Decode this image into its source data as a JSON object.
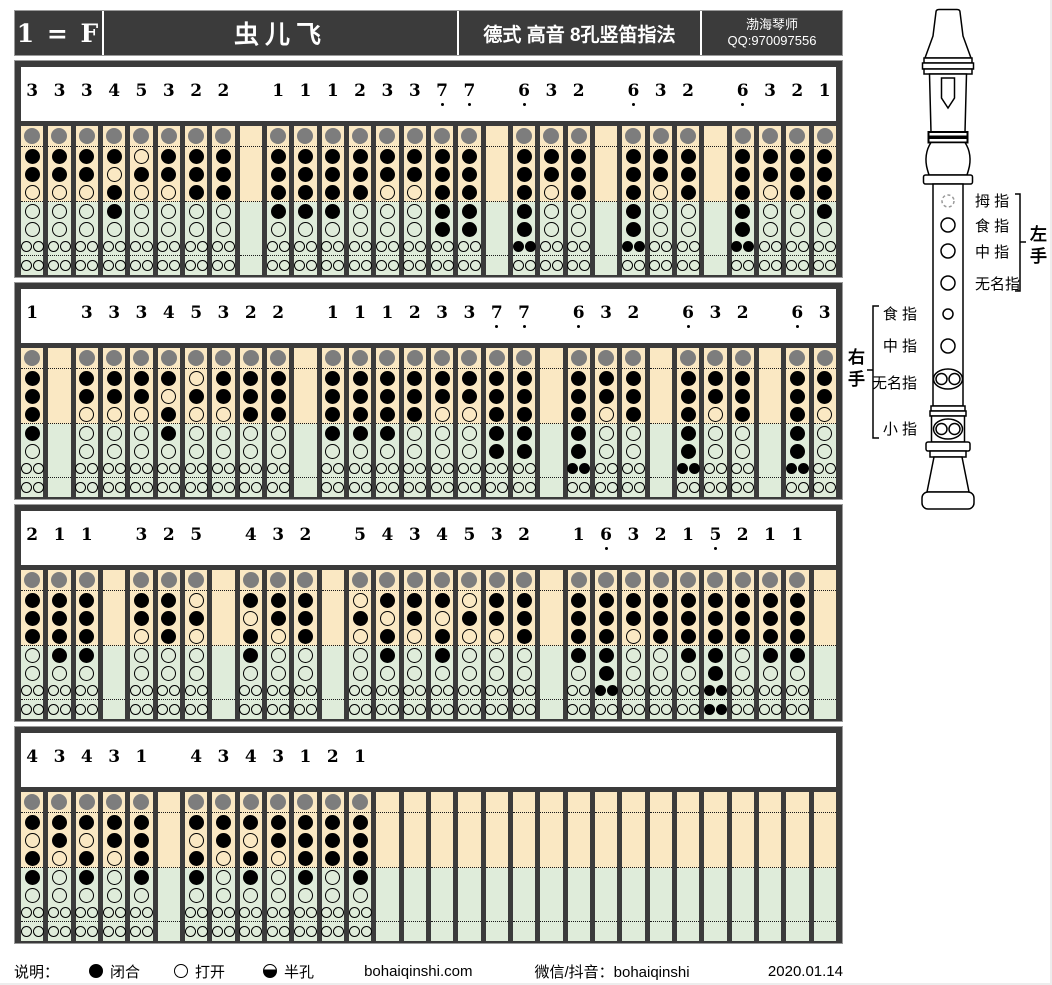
{
  "header": {
    "key_label": "1 = F",
    "title": "虫儿飞",
    "subtitle": "德式 高音 8孔竖笛指法",
    "author": "渤海琴师",
    "qq": "QQ:970097556"
  },
  "legend": {
    "label": "说明：",
    "closed": "闭合",
    "open": "打开",
    "half": "半孔",
    "website": "bohaiqinshi.com",
    "social": "微信/抖音：bohaiqinshi",
    "date": "2020.01.14"
  },
  "recorder": {
    "hand_left": "左手",
    "hand_right": "右手",
    "labels_left": [
      "拇 指",
      "食 指",
      "中 指",
      "无名指"
    ],
    "labels_right": [
      "食 指",
      "中 指",
      "无名指",
      "小 指"
    ]
  },
  "colors": {
    "frame": "#3b3b3b",
    "tan": "#fae8c3",
    "green": "#dfecda",
    "thumb_gray": "#7d7d7d"
  },
  "chart_data": {
    "type": "table",
    "description": "Recorder fingering chart; each row slot is a scale-degree note ('.' = low octave dot) or '' for a gap column. Fingerings list hole states top-to-bottom [thumb,1,2,3,4,5,6,7]; 1=closed, 0=open; holes 6 and 7 are double holes.",
    "rows": [
      [
        "3",
        "3",
        "3",
        "4",
        "5",
        "3",
        "2",
        "2",
        "",
        "1",
        "1",
        "1",
        "2",
        "3",
        "3",
        "7.",
        "7.",
        "",
        "6.",
        "3",
        "2",
        "",
        "6.",
        "3",
        "2",
        "",
        "6.",
        "3",
        "2",
        "1"
      ],
      [
        "1",
        "",
        "3",
        "3",
        "3",
        "4",
        "5",
        "3",
        "2",
        "2",
        "",
        "1",
        "1",
        "1",
        "2",
        "3",
        "3",
        "7.",
        "7.",
        "",
        "6.",
        "3",
        "2",
        "",
        "6.",
        "3",
        "2",
        "",
        "6.",
        "3"
      ],
      [
        "2",
        "1",
        "1",
        "",
        "3",
        "2",
        "5",
        "",
        "4",
        "3",
        "2",
        "",
        "5",
        "4",
        "3",
        "4",
        "5",
        "3",
        "2",
        "",
        "1",
        "6.",
        "3",
        "2",
        "1",
        "5.",
        "2",
        "1",
        "1",
        ""
      ],
      [
        "4",
        "3",
        "4",
        "3",
        "1",
        "",
        "4",
        "3",
        "4",
        "3",
        "1",
        "2",
        "1",
        "",
        "",
        "",
        "",
        "",
        "",
        "",
        "",
        "",
        "",
        "",
        "",
        "",
        "",
        "",
        "",
        ""
      ]
    ],
    "fingerings": {
      "1": [
        1,
        1,
        1,
        1,
        1,
        0,
        0,
        0
      ],
      "2": [
        1,
        1,
        1,
        1,
        0,
        0,
        0,
        0
      ],
      "3": [
        1,
        1,
        1,
        0,
        0,
        0,
        0,
        0
      ],
      "4": [
        1,
        1,
        0,
        1,
        1,
        0,
        0,
        0
      ],
      "5": [
        1,
        0,
        1,
        0,
        0,
        0,
        0,
        0
      ],
      "6.": [
        1,
        1,
        1,
        1,
        1,
        1,
        1,
        0
      ],
      "7.": [
        1,
        1,
        1,
        1,
        1,
        1,
        0,
        0
      ],
      "5.": [
        1,
        1,
        1,
        1,
        1,
        1,
        1,
        1
      ]
    }
  }
}
